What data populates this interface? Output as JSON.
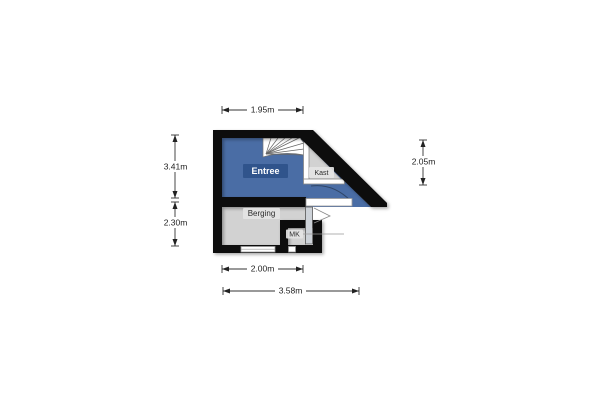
{
  "floorplan": {
    "rooms": {
      "entree": {
        "label": "Entree"
      },
      "kast": {
        "label": "Kast"
      },
      "berging": {
        "label": "Berging"
      },
      "mk": {
        "label": "MK"
      }
    },
    "dimensions": {
      "top": "1.95m",
      "left_upper": "3.41m",
      "left_lower": "2.30m",
      "right": "2.05m",
      "bottom_inner": "2.00m",
      "bottom_outer": "3.58m"
    },
    "colors": {
      "wall": "#0a0a0a",
      "entree_floor": "#4a6da5",
      "entree_label_bg": "#30548c",
      "secondary_floor": "#d2d2d2",
      "label_bg": "#e4e4e4",
      "dimension_text": "#222222"
    }
  }
}
